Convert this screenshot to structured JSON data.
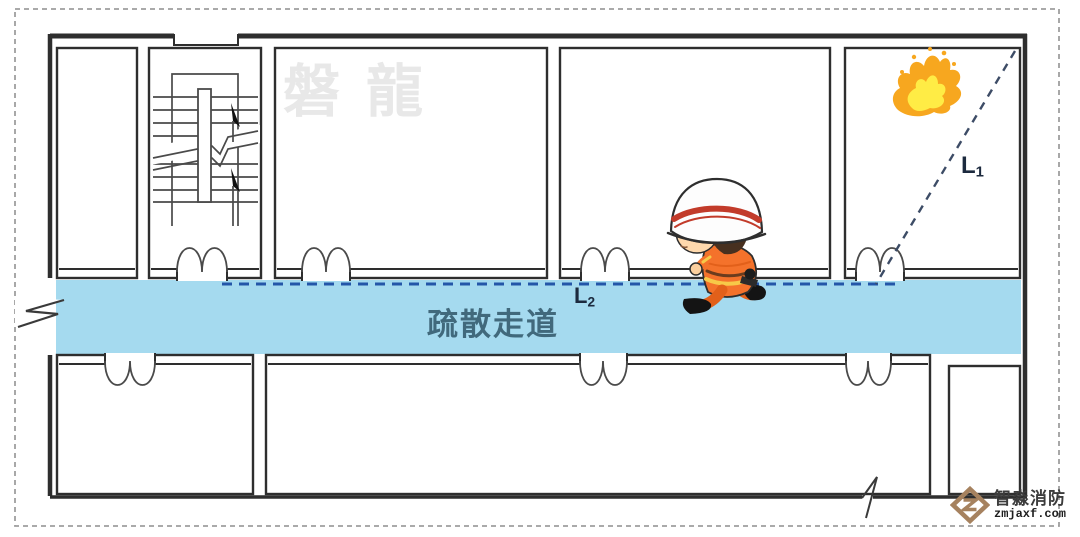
{
  "diagram": {
    "title_semantic": "evacuation corridor floor plan",
    "watermark": {
      "text": "磐龍"
    },
    "corridor": {
      "label": "疏散走道"
    },
    "labels": {
      "l1": {
        "base": "L",
        "sub": "1"
      },
      "l2": {
        "base": "L",
        "sub": "2"
      }
    },
    "logo": {
      "company": "智淼消防",
      "site": "zmjaxf.com"
    },
    "icons": [
      "fire-icon",
      "firefighter-illustration",
      "stairs-icon",
      "double-door-icon",
      "break-mark-icon",
      "zm-diamond-logo"
    ],
    "colors": {
      "corridor_fill": "#a5daef",
      "evacuation_path": "#2456a8",
      "travel_line": "#3d4c66",
      "wall": "#2e2e2e",
      "corridor_text": "#41697c",
      "watermark_text": "#e8e8e8",
      "flame_orange": "#f7a71f",
      "flame_yellow": "#ffec45",
      "logo_bronze": "#a6825f",
      "helmet_stripe_red": "#c23b2a",
      "suit_orange": "#f4722b"
    }
  }
}
